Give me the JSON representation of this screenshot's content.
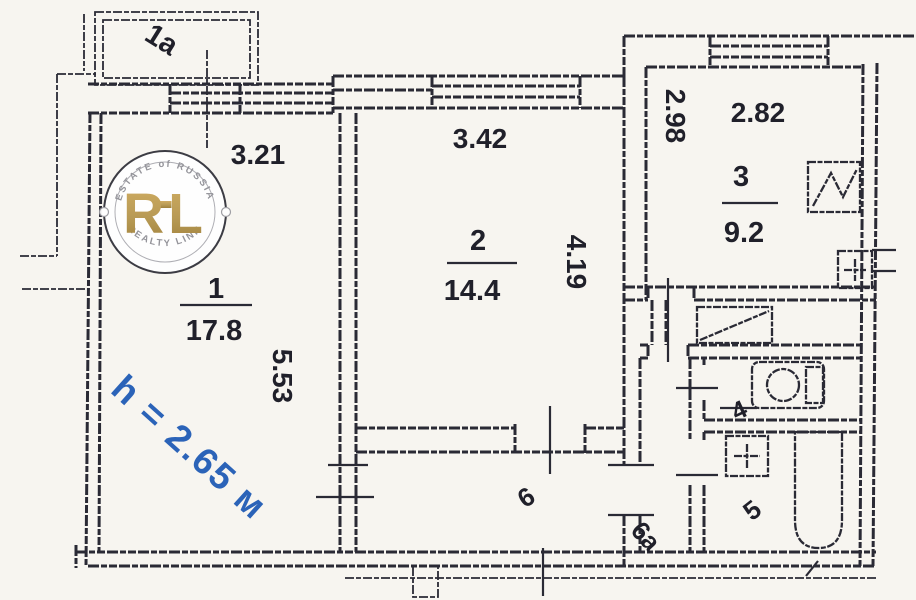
{
  "plan": {
    "balcony_label": "1a",
    "rooms": {
      "room1": {
        "number": "1",
        "area": "17.8",
        "dim_top": "3.21",
        "dim_side": "5.53"
      },
      "room2": {
        "number": "2",
        "area": "14.4",
        "dim_top": "3.42",
        "dim_side": "4.19"
      },
      "room3": {
        "number": "3",
        "area": "9.2",
        "dim_top": "2.82",
        "dim_side": "2.98"
      },
      "wc_label": "4",
      "bath_label": "5",
      "hall_label": "6",
      "vestibule_label": "6a"
    },
    "ceiling_height_note": "h = 2.65 м",
    "watermark": {
      "arc_top": "ESTATE of RUSSIA",
      "brand": "RL",
      "arc_bottom": "REALTY LINK"
    },
    "colors": {
      "ink": "#2a2a35",
      "height_note_blue": "#2b63b8",
      "watermark_gold": "#b5964d",
      "paper": "#f7f5f0"
    }
  }
}
